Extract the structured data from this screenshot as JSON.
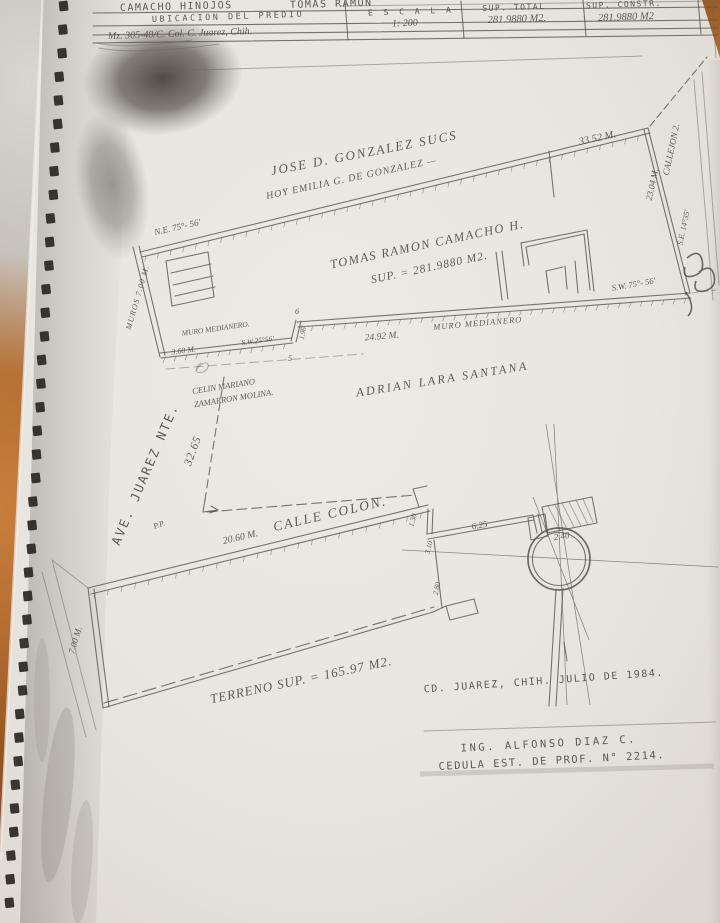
{
  "title_block": {
    "owner_surnames": "CAMACHO HINOJOS",
    "owner_given": "TOMAS RAMON",
    "location_label": "UBICACION DEL PREDIO",
    "location_value": "Mz. 305-40/C. Col. C. Juarez, Chih.",
    "scale_label": "E S C A L A",
    "scale_value": "1: 200",
    "sup_total_label": "SUP. TOTAL",
    "sup_total_value": "281.9880 M2.",
    "sup_constr_label": "SUP. CONSTR.",
    "sup_constr_value": "281.9880 M2"
  },
  "plan": {
    "neighbor_north_line1": "JOSE D. GONZALEZ SUCS",
    "neighbor_north_line2": "HOY EMILIA G. DE GONZALEZ —",
    "parcel_owner_line1": "TOMAS RAMON CAMACHO H.",
    "parcel_owner_line2": "SUP. = 281.9880 M2.",
    "neighbor_south": "ADRIAN LARA SANTANA",
    "neighbor_sw_line1": "CELIN MARIANO",
    "neighbor_sw_line2": "ZAMARRON MOLINA.",
    "street_west": "AVE. JUAREZ NTE.",
    "street_south": "CALLE COLON.",
    "alley_east": "CALLEJON 2.",
    "party_wall_left": "MURO MEDIANERO.",
    "party_wall_right": "MURO MEDIANERO",
    "west_edge_note": "MUROS 7.00 M.",
    "bearing_ne": "N.E. 75°- 56'",
    "bearing_sw": "S.W. 75°- 56'",
    "bearing_sw2": "S.W.25°56'",
    "bearing_se": "S.E. 14°35'",
    "point_label": "P.P.",
    "lot_number": "5",
    "jog_number": "6",
    "terreno_note": "TERRENO SUP. = 165.97 M2."
  },
  "dimensions": {
    "top": "33.52 M.",
    "east": "23.04 M.",
    "wall": "24.92 M.",
    "step": "3.60 M.",
    "west_depth": "32.65",
    "colon_front": "20.60 M.",
    "d625": "6.25",
    "d240": "2.40",
    "d130": "1.30",
    "d310": "3.10",
    "d280": "2.80",
    "d700": "7.00 M.",
    "jog": "1.96'"
  },
  "footer": {
    "place_date": "CD. JUAREZ, CHIH. JULIO DE 1984.",
    "engineer": "ING. ALFONSO DIAZ C.",
    "license": "CEDULA EST. DE PROF. N° 2214."
  }
}
